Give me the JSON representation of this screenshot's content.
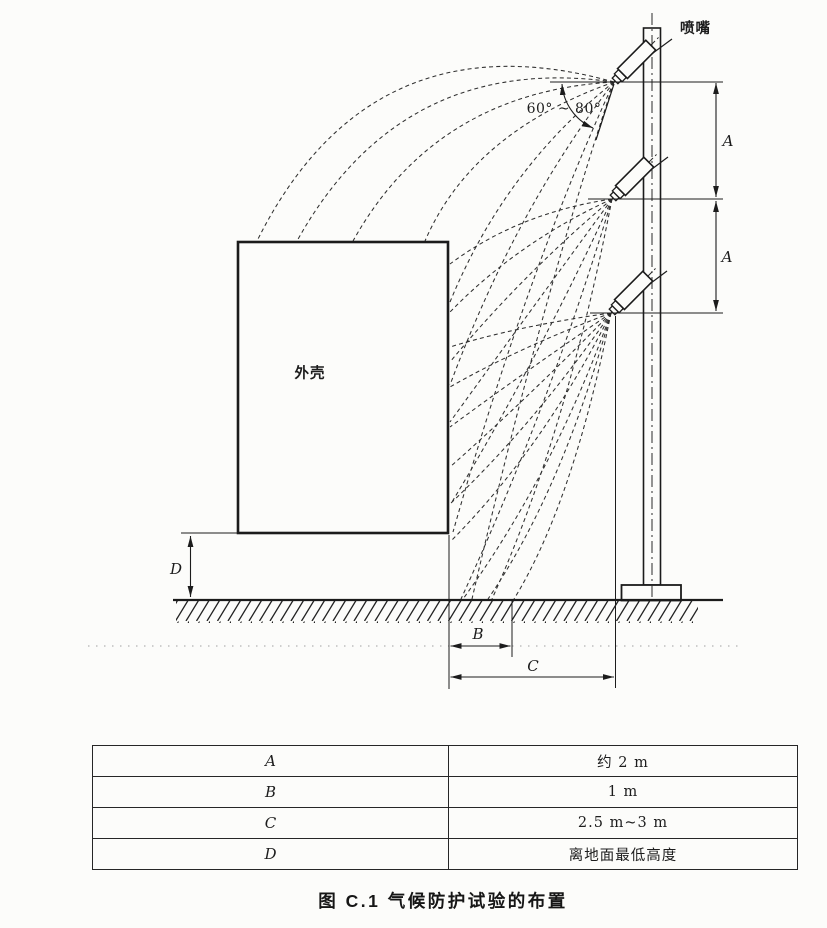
{
  "diagram": {
    "nozzle_label": "喷嘴",
    "enclosure_label": "外壳",
    "angle_label": "60° ~ 80°",
    "dim_a": "A",
    "dim_b": "B",
    "dim_c": "C",
    "dim_d": "D"
  },
  "table": {
    "rows": [
      {
        "param": "A",
        "value": "约 2 m"
      },
      {
        "param": "B",
        "value": "1 m"
      },
      {
        "param": "C",
        "value": "2.5 m~3 m"
      },
      {
        "param": "D",
        "value": "离地面最低高度"
      }
    ]
  },
  "caption": "图 C.1  气候防护试验的布置",
  "colors": {
    "ink": "#1c1c1c",
    "paper": "#fcfcfa",
    "faint_line": "#a0a0a0"
  }
}
